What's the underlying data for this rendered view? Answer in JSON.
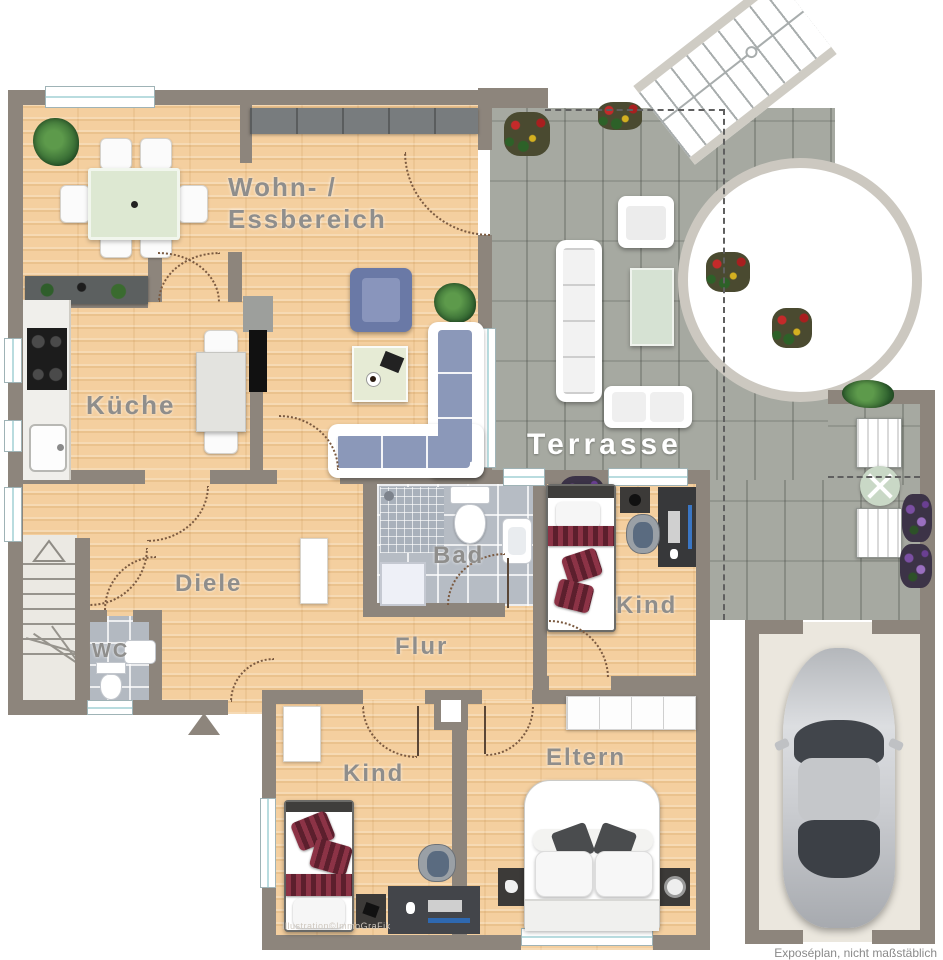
{
  "type": "floor-plan",
  "rooms": {
    "wohn_line1": "Wohn- /",
    "wohn_line2": "Essbereich",
    "kueche": "Küche",
    "terrasse": "Terrasse",
    "bad": "Bad",
    "diele": "Diele",
    "wc": "WC",
    "flur": "Flur",
    "kind_mitte": "Kind",
    "kind_unten": "Kind",
    "eltern": "Eltern"
  },
  "footer": {
    "credit": "Illustration©ImmoGraFik",
    "disclaimer": "Exposéplan, nicht maßstäblich"
  },
  "colors": {
    "wall": "#8d857c",
    "wood_floor": "#f4cf9f",
    "terrace_tile": "#a6a9a1",
    "bath_tile": "#b6bcc4",
    "garage_floor": "#ebe7de",
    "label": "#8f8e8c",
    "label_terrace": "#ffffff",
    "sofa_blue": "#7383ac",
    "pillow_red": "#82293a",
    "table_green": "#dfe8d6"
  }
}
